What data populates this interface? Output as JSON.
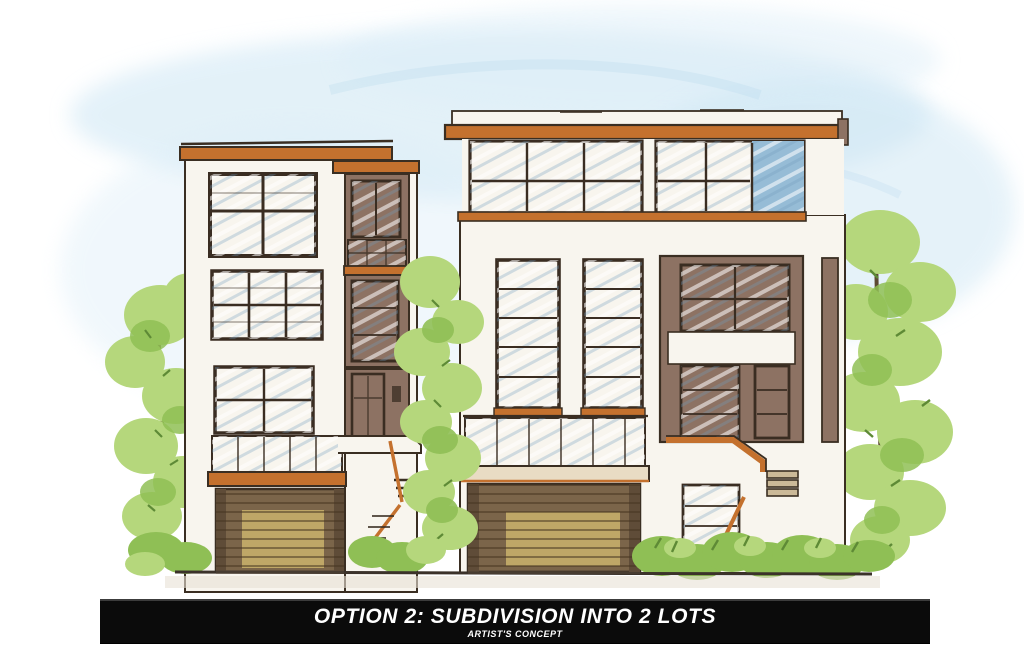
{
  "banner": {
    "title": "OPTION 2: SUBDIVISION INTO 2 LOTS",
    "subtitle": "ARTIST'S CONCEPT"
  },
  "scene": {
    "description": "Hand-drawn marker-and-watercolor architectural elevation of two modern flat-roofed townhomes (a proposed 2-lot subdivision): left 4-story home and larger right home, both with orange roof fascias, large blue-glass windows, glass-railed balconies, slatted garage doors, side entry stairs, and green trees and shrubs on a white background."
  },
  "palette": {
    "sky1": "#cde6f4",
    "sky2": "#ddeef8",
    "wall": "#f8f5ee",
    "line": "#3a2e22",
    "fascia": "#c4712e",
    "taupe": "#8d7263",
    "glass1": "#cfe2ef",
    "glass2": "#a7c7dd",
    "glassDark": "#96bcd6",
    "mullion": "#3a2d22",
    "garageWood": "#7b654a",
    "garageTan": "#c3ab68",
    "leafLight": "#b5d77c",
    "leafMid": "#8fbf55",
    "leafDark": "#5e8a36",
    "trunk": "#5d4a33",
    "ground": "#3b322a",
    "bannerBg": "#0b0b0b",
    "bannerText": "#ffffff"
  }
}
